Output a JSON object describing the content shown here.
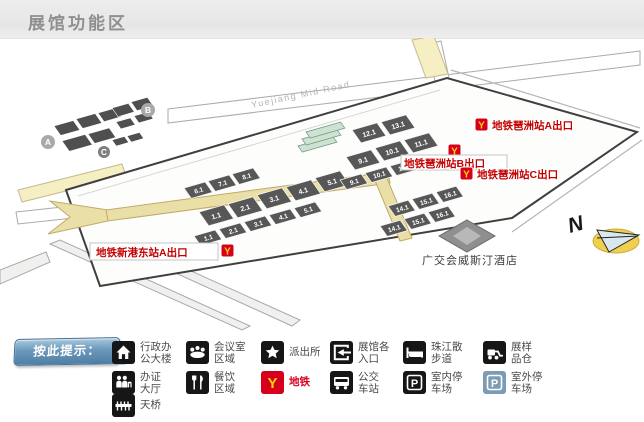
{
  "header": {
    "title": "展馆功能区"
  },
  "map": {
    "road_label": "Yuejiang Mid Road",
    "inset": {
      "a": "A",
      "b": "B",
      "c": "C"
    },
    "compass_label": "N",
    "hotel_label": "广交会威斯汀酒店",
    "metro_icon_letter": "Y",
    "parking_letter": "P",
    "metro_exits": {
      "pazhou_a": "地铁琶洲站A出口",
      "pazhou_b": "地铁琶洲站B出口",
      "pazhou_c": "地铁琶洲站C出口",
      "xingangdong_a": "地铁新港东站A出口"
    },
    "halls": {
      "a_back": [
        "6.1",
        "7.1",
        "8.1"
      ],
      "a_mid": [
        "1.1",
        "2.1",
        "3.1",
        "4.1",
        "5.1"
      ],
      "a_front": [
        "1.1",
        "2.1",
        "3.1",
        "4.1",
        "5.1"
      ],
      "b_back": [
        "12.1",
        "13.1"
      ],
      "b_mid": [
        "9.1",
        "10.1",
        "11.1"
      ],
      "b_front": [
        "9.1",
        "10.1",
        "11.1"
      ],
      "c_back": [
        "14.1",
        "15.1",
        "16.1"
      ],
      "c_front": [
        "14.1",
        "15.1",
        "16.1"
      ]
    }
  },
  "legend": {
    "button_label": "按此提示：",
    "colors": {
      "metro_red": "#d6001c",
      "metro_yellow": "#ffd400",
      "outdoor_parking_blue": "#7b9cb4"
    },
    "items": [
      {
        "name": "admin-building",
        "line1": "行政办",
        "line2": "公大楼"
      },
      {
        "name": "meeting-room-area",
        "line1": "会议室",
        "line2": "区域"
      },
      {
        "name": "police-station",
        "line1": "派出所",
        "line2": ""
      },
      {
        "name": "hall-entrances",
        "line1": "展馆各",
        "line2": "入口"
      },
      {
        "name": "pearl-river-promenade",
        "line1": "珠江散",
        "line2": "步道"
      },
      {
        "name": "sample-warehouse",
        "line1": "展样",
        "line2": "品仓"
      },
      {
        "name": "badge-hall",
        "line1": "办证",
        "line2": "大厅"
      },
      {
        "name": "dining-area",
        "line1": "餐饮",
        "line2": "区域"
      },
      {
        "name": "metro",
        "line1": "地铁",
        "line2": ""
      },
      {
        "name": "bus-station",
        "line1": "公交",
        "line2": "车站"
      },
      {
        "name": "indoor-parking",
        "line1": "室内停",
        "line2": "车场"
      },
      {
        "name": "outdoor-parking",
        "line1": "室外停",
        "line2": "车场"
      },
      {
        "name": "footbridge",
        "line1": "天桥",
        "line2": ""
      }
    ]
  }
}
